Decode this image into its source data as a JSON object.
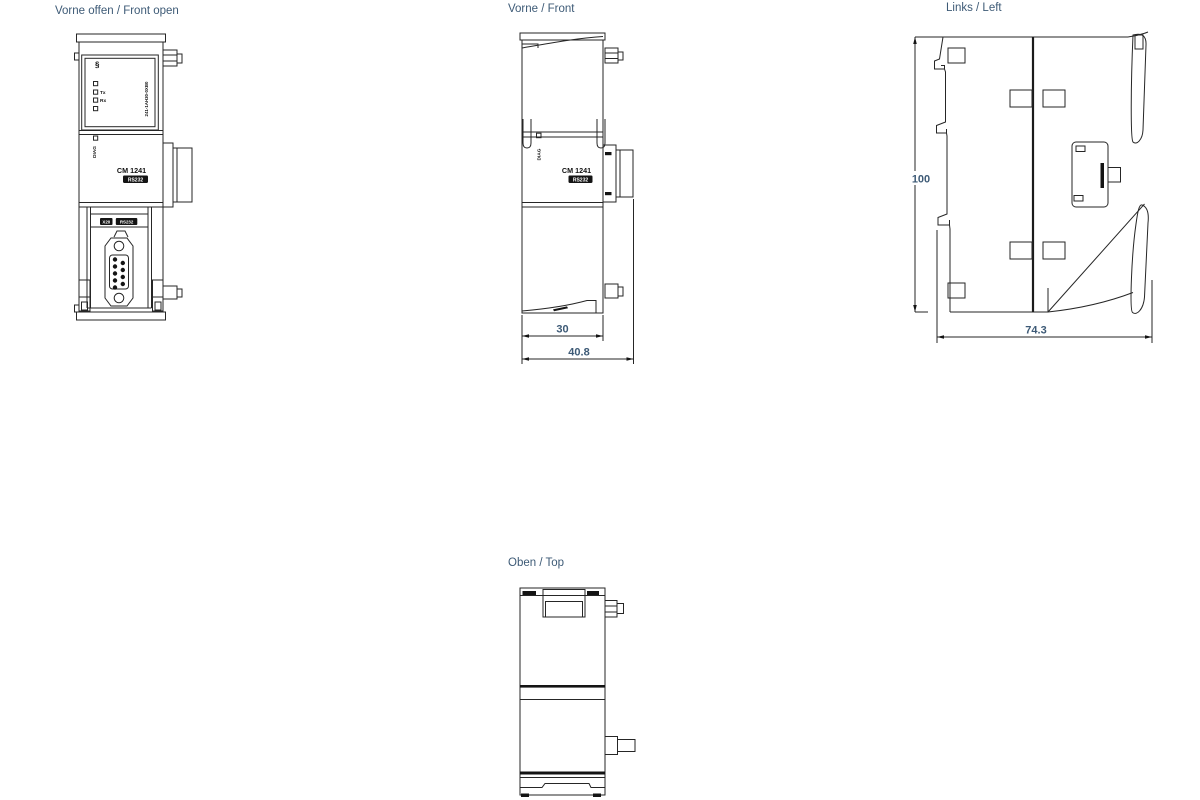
{
  "colors": {
    "caption": "#3d5a76",
    "dim": "#3d5a76",
    "line": "#262626"
  },
  "views": {
    "front_open": {
      "caption": "Vorne offen / Front open",
      "module": {
        "mark": "§",
        "tx": "Tx",
        "rx": "Rx",
        "order_number": "241-1AH30-0XB0",
        "diag": "DIAG",
        "model": "CM 1241",
        "type": "RS232",
        "port_x": "X20",
        "port_type": "RS232"
      }
    },
    "front": {
      "caption": "Vorne / Front",
      "module": {
        "diag": "DIAG",
        "model": "CM 1241",
        "type": "RS232"
      },
      "dims": {
        "body_width_mm": "30",
        "total_width_mm": "40.8"
      }
    },
    "left": {
      "caption": "Links / Left",
      "dims": {
        "height_mm": "100",
        "depth_mm": "74.3"
      }
    },
    "top": {
      "caption": "Oben / Top"
    }
  }
}
